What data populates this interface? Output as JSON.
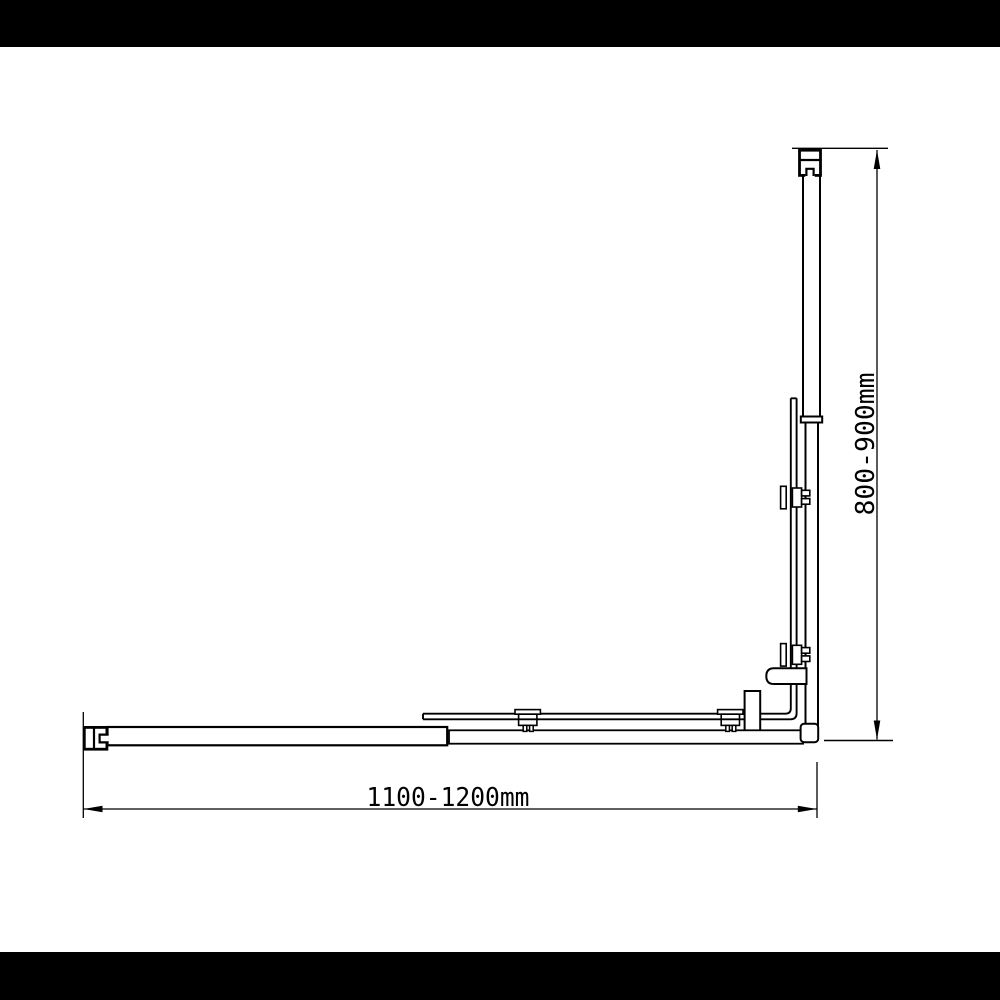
{
  "scene": {
    "letterbox_color": "#000000",
    "canvas_color": "#ffffff",
    "line_color": "#000000"
  },
  "dimensions": {
    "width_label": "1100-1200mm",
    "height_label": "800-900mm"
  }
}
